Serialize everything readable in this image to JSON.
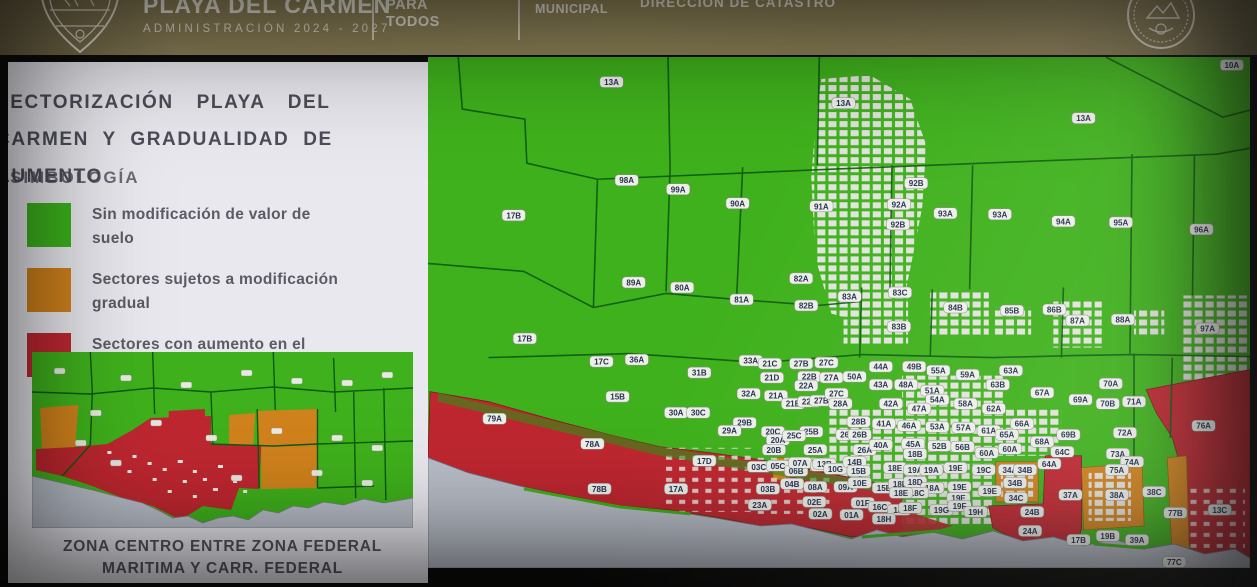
{
  "header": {
    "brand_title": "PLAYA DEL CARMEN",
    "brand_subtitle": "ADMINISTRACIÓN 2024 - 2027",
    "slogan_line1": "PARA",
    "slogan_line2": "TODOS",
    "dept_line1": "TESORERÍA",
    "dept_line2": "MUNICIPAL",
    "direction": "DIRECCIÓN DE CATASTRO",
    "bg_color": "#8b7f58"
  },
  "panel": {
    "title_line1": "SECTORIZACIÓN PLAYA DEL",
    "title_line2": "CARMEN Y GRADUALIDAD DE",
    "title_line3": "AUMENTO",
    "legend_heading": "SIMBOLOGÍA",
    "legend": [
      {
        "color": "#3cb31d",
        "label": "Sin modificación de valor de suelo"
      },
      {
        "color": "#d0821c",
        "label": "Sectores sujetos a modificación gradual"
      },
      {
        "color": "#c02832",
        "label": "Sectores con aumento en el valor de suelo"
      }
    ],
    "inset_caption_line1": "ZONA CENTRO ENTRE ZONA FEDERAL",
    "inset_caption_line2": "MARITIMA Y CARR. FEDERAL"
  },
  "map": {
    "colors": {
      "green": "#3fb11c",
      "orange": "#d0821c",
      "red": "#bf2730",
      "sea": "#b8bdc7",
      "urban": "#e2e3dd",
      "boundary": "#0d5a11"
    },
    "labels": [
      [
        "13A",
        182,
        25
      ],
      [
        "13A",
        412,
        46
      ],
      [
        "13A",
        650,
        61
      ],
      [
        "10A",
        797,
        8
      ],
      [
        "98A",
        197,
        123
      ],
      [
        "99A",
        248,
        132
      ],
      [
        "90A",
        307,
        146
      ],
      [
        "91A",
        390,
        149
      ],
      [
        "17B",
        85,
        158
      ],
      [
        "92B",
        484,
        126
      ],
      [
        "92A",
        467,
        147
      ],
      [
        "92B",
        466,
        167
      ],
      [
        "93A",
        513,
        156
      ],
      [
        "93A",
        567,
        157
      ],
      [
        "94A",
        630,
        164
      ],
      [
        "95A",
        687,
        165
      ],
      [
        "96A",
        767,
        172
      ],
      [
        "89A",
        204,
        225
      ],
      [
        "80A",
        252,
        230
      ],
      [
        "81A",
        311,
        242
      ],
      [
        "82A",
        370,
        221
      ],
      [
        "82B",
        375,
        248
      ],
      [
        "17B",
        96,
        281
      ],
      [
        "17C",
        172,
        304
      ],
      [
        "36A",
        207,
        302
      ],
      [
        "15B",
        188,
        339
      ],
      [
        "31B",
        269,
        315
      ],
      [
        "33A",
        320,
        303
      ],
      [
        "21C",
        339,
        306
      ],
      [
        "27B",
        370,
        306
      ],
      [
        "27C",
        395,
        305
      ],
      [
        "22B",
        378,
        319
      ],
      [
        "27A",
        400,
        320
      ],
      [
        "21D",
        341,
        320
      ],
      [
        "22A",
        375,
        328
      ],
      [
        "32A",
        318,
        336
      ],
      [
        "21A",
        345,
        338
      ],
      [
        "21B",
        362,
        346
      ],
      [
        "22B",
        378,
        344
      ],
      [
        "27B",
        390,
        343
      ],
      [
        "27C",
        405,
        336
      ],
      [
        "28A",
        409,
        346
      ],
      [
        "83A",
        418,
        239
      ],
      [
        "83C",
        468,
        235
      ],
      [
        "83B",
        467,
        269
      ],
      [
        "84B",
        523,
        250
      ],
      [
        "85B",
        579,
        253
      ],
      [
        "86B",
        621,
        252
      ],
      [
        "87A",
        644,
        263
      ],
      [
        "88A",
        689,
        262
      ],
      [
        "97A",
        773,
        271
      ],
      [
        "44A",
        449,
        309
      ],
      [
        "49B",
        482,
        309
      ],
      [
        "55A",
        506,
        313
      ],
      [
        "59A",
        535,
        317
      ],
      [
        "63A",
        578,
        313
      ],
      [
        "50A",
        423,
        319
      ],
      [
        "43A",
        449,
        327
      ],
      [
        "48A",
        474,
        327
      ],
      [
        "63B",
        565,
        327
      ],
      [
        "67A",
        609,
        335
      ],
      [
        "51A",
        500,
        333
      ],
      [
        "54A",
        505,
        342
      ],
      [
        "58A",
        533,
        346
      ],
      [
        "42A",
        459,
        346
      ],
      [
        "47A",
        487,
        351
      ],
      [
        "69A",
        647,
        342
      ],
      [
        "70A",
        677,
        326
      ],
      [
        "70B",
        674,
        346
      ],
      [
        "71A",
        700,
        344
      ],
      [
        "79A",
        66,
        361
      ],
      [
        "78A",
        163,
        386
      ],
      [
        "78B",
        170,
        431
      ],
      [
        "17D",
        274,
        403
      ],
      [
        "17A",
        246,
        431
      ],
      [
        "30A",
        246,
        355
      ],
      [
        "30C",
        268,
        355
      ],
      [
        "29B",
        314,
        365
      ],
      [
        "29A",
        299,
        373
      ],
      [
        "20C",
        342,
        374
      ],
      [
        "20A",
        347,
        382
      ],
      [
        "20B",
        343,
        392
      ],
      [
        "25B",
        380,
        374
      ],
      [
        "25C",
        363,
        378
      ],
      [
        "25A",
        384,
        392
      ],
      [
        "26C",
        416,
        377
      ],
      [
        "26B",
        428,
        377
      ],
      [
        "26A",
        433,
        392
      ],
      [
        "28B",
        427,
        364
      ],
      [
        "03C",
        328,
        409
      ],
      [
        "05C",
        347,
        408
      ],
      [
        "06B",
        365,
        413
      ],
      [
        "07A",
        369,
        405
      ],
      [
        "11A",
        391,
        408
      ],
      [
        "04B",
        361,
        426
      ],
      [
        "08A",
        384,
        429
      ],
      [
        "03B",
        337,
        431
      ],
      [
        "23A",
        329,
        447
      ],
      [
        "02E",
        383,
        444
      ],
      [
        "02A",
        389,
        456
      ],
      [
        "41A",
        452,
        366
      ],
      [
        "46A",
        477,
        368
      ],
      [
        "53A",
        505,
        369
      ],
      [
        "57A",
        531,
        370
      ],
      [
        "61A",
        556,
        373
      ],
      [
        "65A",
        574,
        377
      ],
      [
        "66A",
        589,
        366
      ],
      [
        "62A",
        561,
        351
      ],
      [
        "40A",
        449,
        387
      ],
      [
        "45A",
        481,
        386
      ],
      [
        "52B",
        507,
        388
      ],
      [
        "56B",
        530,
        389
      ],
      [
        "60A",
        554,
        395
      ],
      [
        "60A",
        577,
        391
      ],
      [
        "18B",
        483,
        396
      ],
      [
        "68A",
        609,
        384
      ],
      [
        "69B",
        635,
        377
      ],
      [
        "64C",
        629,
        394
      ],
      [
        "64A",
        616,
        406
      ],
      [
        "13B",
        393,
        406
      ],
      [
        "10G",
        404,
        411
      ],
      [
        "14B",
        423,
        404
      ],
      [
        "15B",
        427,
        413
      ],
      [
        "18E",
        463,
        410
      ],
      [
        "19A",
        483,
        412
      ],
      [
        "19A",
        499,
        412
      ],
      [
        "19E",
        523,
        410
      ],
      [
        "19C",
        551,
        412
      ],
      [
        "34A",
        577,
        412
      ],
      [
        "34B",
        592,
        412
      ],
      [
        "34B",
        582,
        425
      ],
      [
        "09A",
        414,
        429
      ],
      [
        "10E",
        428,
        425
      ],
      [
        "15E",
        452,
        430
      ],
      [
        "18E",
        468,
        426
      ],
      [
        "18D",
        483,
        424
      ],
      [
        "18A",
        500,
        430
      ],
      [
        "18C",
        485,
        435
      ],
      [
        "18E",
        469,
        435
      ],
      [
        "19E",
        527,
        429
      ],
      [
        "19E",
        526,
        440
      ],
      [
        "19E",
        557,
        433
      ],
      [
        "34C",
        583,
        440
      ],
      [
        "01F",
        431,
        445
      ],
      [
        "16C",
        448,
        449
      ],
      [
        "18I",
        467,
        452
      ],
      [
        "18F",
        478,
        450
      ],
      [
        "19G",
        509,
        452
      ],
      [
        "19F",
        527,
        448
      ],
      [
        "19H",
        543,
        454
      ],
      [
        "01A",
        420,
        457
      ],
      [
        "18H",
        452,
        461
      ],
      [
        "24B",
        599,
        454
      ],
      [
        "24A",
        597,
        473
      ],
      [
        "72A",
        691,
        375
      ],
      [
        "73A",
        684,
        396
      ],
      [
        "74A",
        698,
        404
      ],
      [
        "75A",
        683,
        412
      ],
      [
        "37A",
        637,
        437
      ],
      [
        "38A",
        683,
        437
      ],
      [
        "38C",
        720,
        434
      ],
      [
        "77B",
        741,
        455
      ],
      [
        "76A",
        769,
        368
      ],
      [
        "13C",
        785,
        452
      ],
      [
        "17B",
        645,
        482
      ],
      [
        "19B",
        674,
        478
      ],
      [
        "39A",
        703,
        482
      ],
      [
        "77C",
        740,
        504
      ]
    ]
  }
}
